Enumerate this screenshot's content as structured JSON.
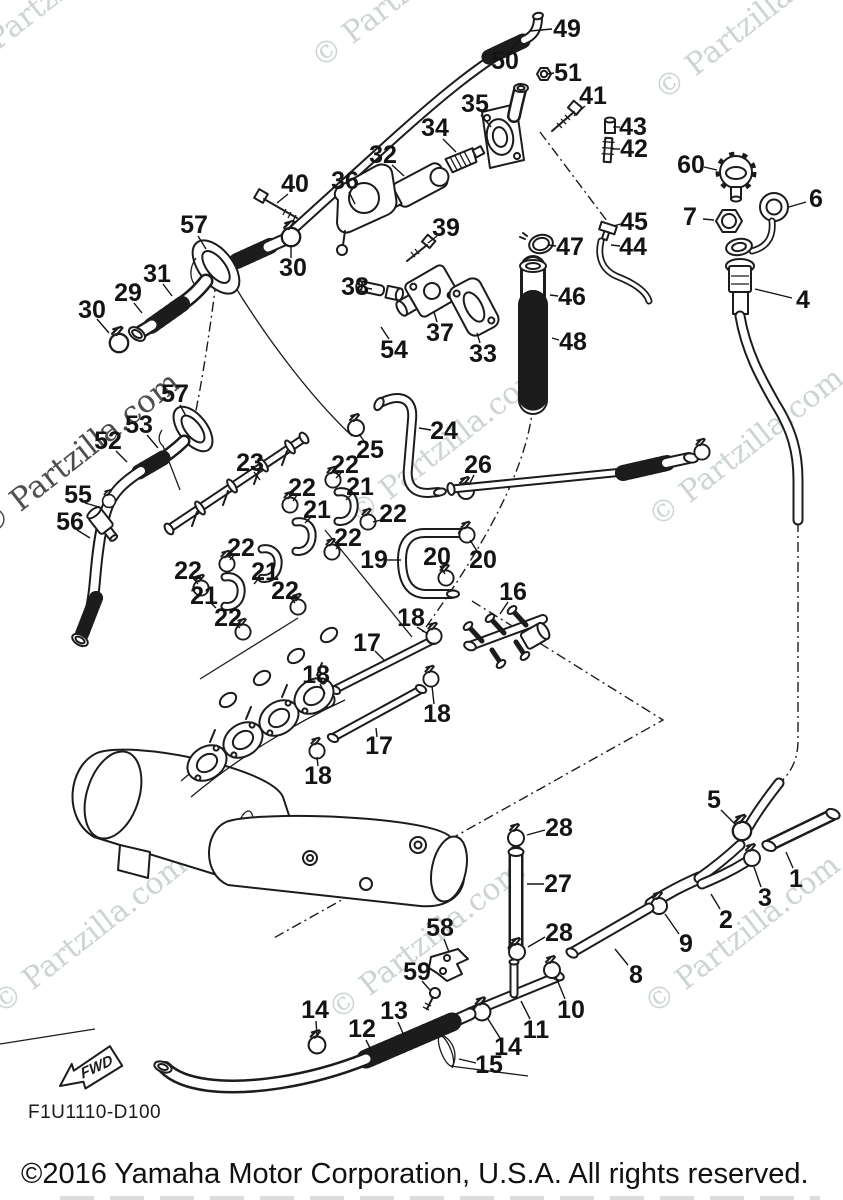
{
  "watermarks": {
    "text": "© Partzilla.com",
    "light_color": "#ccd5d1",
    "dark_color": "#4e4e4e",
    "items": [
      {
        "x": 60,
        "y": 2,
        "r": -38,
        "dark": false
      },
      {
        "x": 415,
        "y": -4,
        "r": -38,
        "dark": false
      },
      {
        "x": 758,
        "y": 28,
        "r": -38,
        "dark": false
      },
      {
        "x": 85,
        "y": 462,
        "r": -38,
        "dark": true
      },
      {
        "x": 452,
        "y": 452,
        "r": -38,
        "dark": false
      },
      {
        "x": 752,
        "y": 455,
        "r": -38,
        "dark": false
      },
      {
        "x": 95,
        "y": 942,
        "r": -38,
        "dark": false
      },
      {
        "x": 432,
        "y": 948,
        "r": -38,
        "dark": false
      },
      {
        "x": 748,
        "y": 942,
        "r": -38,
        "dark": false
      }
    ]
  },
  "diagram": {
    "code": "F1U1110-D100",
    "fwd_label": "FWD",
    "labels": [
      {
        "n": "49",
        "x": 567,
        "y": 29,
        "l": [
          552,
          29,
          530,
          31
        ]
      },
      {
        "n": "50",
        "x": 505,
        "y": 61,
        "l": [
          511,
          50,
          520,
          39
        ]
      },
      {
        "n": "51",
        "x": 568,
        "y": 73,
        "l": [
          554,
          73,
          547,
          74
        ]
      },
      {
        "n": "35",
        "x": 475,
        "y": 104,
        "l": [
          481,
          115,
          491,
          127
        ]
      },
      {
        "n": "41",
        "x": 593,
        "y": 96,
        "l": [
          585,
          106,
          574,
          116
        ]
      },
      {
        "n": "34",
        "x": 435,
        "y": 128,
        "l": [
          443,
          139,
          456,
          152
        ]
      },
      {
        "n": "43",
        "x": 633,
        "y": 127,
        "l": [
          620,
          127,
          613,
          127
        ]
      },
      {
        "n": "42",
        "x": 634,
        "y": 149,
        "l": [
          620,
          149,
          612,
          149
        ]
      },
      {
        "n": "60",
        "x": 691,
        "y": 165,
        "l": [
          704,
          167,
          717,
          170
        ]
      },
      {
        "n": "6",
        "x": 816,
        "y": 199,
        "l": [
          806,
          202,
          789,
          207
        ]
      },
      {
        "n": "7",
        "x": 690,
        "y": 217,
        "l": [
          703,
          219,
          714,
          220
        ]
      },
      {
        "n": "40",
        "x": 295,
        "y": 184,
        "l": [
          288,
          194,
          277,
          203
        ]
      },
      {
        "n": "32",
        "x": 383,
        "y": 155,
        "l": [
          392,
          165,
          404,
          176
        ]
      },
      {
        "n": "36",
        "x": 345,
        "y": 181,
        "l": [
          349,
          192,
          355,
          204
        ]
      },
      {
        "n": "57",
        "x": 194,
        "y": 225,
        "l": [
          198,
          236,
          206,
          249
        ]
      },
      {
        "n": "39",
        "x": 446,
        "y": 228,
        "l": [
          437,
          236,
          428,
          243
        ]
      },
      {
        "n": "30",
        "x": 293,
        "y": 268,
        "l": [
          291,
          258,
          291,
          247
        ]
      },
      {
        "n": "31",
        "x": 157,
        "y": 274,
        "l": [
          163,
          284,
          172,
          296
        ]
      },
      {
        "n": "29",
        "x": 128,
        "y": 293,
        "l": [
          134,
          303,
          142,
          313
        ]
      },
      {
        "n": "38",
        "x": 355,
        "y": 287,
        "l": [
          366,
          288,
          372,
          289
        ]
      },
      {
        "n": "30",
        "x": 92,
        "y": 310,
        "l": [
          97,
          319,
          109,
          333
        ]
      },
      {
        "n": "47",
        "x": 570,
        "y": 247,
        "l": [
          556,
          246,
          548,
          245
        ]
      },
      {
        "n": "45",
        "x": 634,
        "y": 222,
        "l": [
          621,
          224,
          613,
          226
        ]
      },
      {
        "n": "44",
        "x": 633,
        "y": 247,
        "l": [
          620,
          246,
          611,
          245
        ]
      },
      {
        "n": "46",
        "x": 572,
        "y": 297,
        "l": [
          558,
          296,
          550,
          295
        ]
      },
      {
        "n": "4",
        "x": 803,
        "y": 300,
        "l": [
          792,
          298,
          755,
          289
        ]
      },
      {
        "n": "37",
        "x": 440,
        "y": 333,
        "l": [
          437,
          322,
          434,
          312
        ]
      },
      {
        "n": "48",
        "x": 573,
        "y": 342,
        "l": [
          559,
          340,
          552,
          338
        ]
      },
      {
        "n": "33",
        "x": 483,
        "y": 354,
        "l": [
          480,
          343,
          477,
          333
        ]
      },
      {
        "n": "54",
        "x": 394,
        "y": 350,
        "l": [
          389,
          339,
          381,
          327
        ]
      },
      {
        "n": "57",
        "x": 175,
        "y": 394,
        "l": [
          180,
          405,
          186,
          416
        ]
      },
      {
        "n": "53",
        "x": 139,
        "y": 425,
        "l": [
          147,
          435,
          158,
          448
        ]
      },
      {
        "n": "52",
        "x": 108,
        "y": 441,
        "l": [
          116,
          451,
          127,
          462
        ]
      },
      {
        "n": "24",
        "x": 444,
        "y": 431,
        "l": [
          431,
          430,
          419,
          428
        ]
      },
      {
        "n": "25",
        "x": 370,
        "y": 450,
        "l": [
          364,
          441,
          359,
          434
        ]
      },
      {
        "n": "23",
        "x": 250,
        "y": 463,
        "l": [
          254,
          472,
          260,
          480
        ]
      },
      {
        "n": "22",
        "x": 345,
        "y": 465,
        "l": [
          341,
          473,
          336,
          478
        ]
      },
      {
        "n": "26",
        "x": 478,
        "y": 465,
        "l": [
          474,
          475,
          469,
          485
        ]
      },
      {
        "n": "22",
        "x": 302,
        "y": 488,
        "l": [
          297,
          495,
          293,
          501
        ]
      },
      {
        "n": "21",
        "x": 360,
        "y": 487,
        "l": [
          352,
          494,
          346,
          500
        ]
      },
      {
        "n": "55",
        "x": 78,
        "y": 495,
        "l": [
          85,
          503,
          99,
          507
        ]
      },
      {
        "n": "21",
        "x": 317,
        "y": 510,
        "l": [
          311,
          517,
          305,
          523
        ]
      },
      {
        "n": "22",
        "x": 393,
        "y": 514,
        "l": [
          385,
          519,
          373,
          522
        ]
      },
      {
        "n": "56",
        "x": 70,
        "y": 522,
        "l": [
          77,
          530,
          90,
          538
        ]
      },
      {
        "n": "22",
        "x": 348,
        "y": 538,
        "l": [
          341,
          544,
          336,
          549
        ]
      },
      {
        "n": "22",
        "x": 241,
        "y": 548,
        "l": [
          235,
          554,
          230,
          560
        ]
      },
      {
        "n": "20",
        "x": 437,
        "y": 557,
        "l": [
          440,
          566,
          445,
          574
        ]
      },
      {
        "n": "19",
        "x": 374,
        "y": 560,
        "l": [
          387,
          560,
          401,
          560
        ]
      },
      {
        "n": "20",
        "x": 483,
        "y": 560,
        "l": [
          477,
          551,
          470,
          540
        ]
      },
      {
        "n": "22",
        "x": 188,
        "y": 571,
        "l": [
          193,
          578,
          198,
          584
        ]
      },
      {
        "n": "21",
        "x": 265,
        "y": 572,
        "l": [
          259,
          578,
          254,
          584
        ]
      },
      {
        "n": "22",
        "x": 285,
        "y": 591,
        "l": [
          290,
          597,
          295,
          603
        ]
      },
      {
        "n": "16",
        "x": 513,
        "y": 592,
        "l": [
          508,
          602,
          500,
          614
        ]
      },
      {
        "n": "21",
        "x": 204,
        "y": 596,
        "l": [
          210,
          602,
          216,
          608
        ]
      },
      {
        "n": "22",
        "x": 228,
        "y": 618,
        "l": [
          234,
          623,
          240,
          628
        ]
      },
      {
        "n": "18",
        "x": 411,
        "y": 618,
        "l": [
          417,
          627,
          428,
          634
        ]
      },
      {
        "n": "17",
        "x": 367,
        "y": 643,
        "l": [
          375,
          651,
          384,
          660
        ]
      },
      {
        "n": "18",
        "x": 316,
        "y": 675,
        "l": [
          320,
          684,
          325,
          694
        ]
      },
      {
        "n": "18",
        "x": 437,
        "y": 714,
        "l": [
          434,
          704,
          432,
          686
        ]
      },
      {
        "n": "17",
        "x": 379,
        "y": 746,
        "l": [
          377,
          737,
          376,
          728
        ]
      },
      {
        "n": "18",
        "x": 318,
        "y": 776,
        "l": [
          318,
          766,
          317,
          757
        ]
      },
      {
        "n": "5",
        "x": 714,
        "y": 800,
        "l": [
          721,
          810,
          736,
          825
        ]
      },
      {
        "n": "28",
        "x": 559,
        "y": 828,
        "l": [
          545,
          830,
          527,
          835
        ]
      },
      {
        "n": "1",
        "x": 796,
        "y": 879,
        "l": [
          793,
          868,
          786,
          852
        ]
      },
      {
        "n": "27",
        "x": 558,
        "y": 884,
        "l": [
          544,
          884,
          527,
          884
        ]
      },
      {
        "n": "3",
        "x": 765,
        "y": 898,
        "l": [
          761,
          887,
          754,
          867
        ]
      },
      {
        "n": "2",
        "x": 726,
        "y": 920,
        "l": [
          720,
          909,
          711,
          894
        ]
      },
      {
        "n": "28",
        "x": 559,
        "y": 933,
        "l": [
          545,
          937,
          528,
          947
        ]
      },
      {
        "n": "9",
        "x": 686,
        "y": 944,
        "l": [
          679,
          934,
          665,
          914
        ]
      },
      {
        "n": "8",
        "x": 636,
        "y": 975,
        "l": [
          628,
          965,
          615,
          949
        ]
      },
      {
        "n": "58",
        "x": 440,
        "y": 928,
        "l": [
          444,
          939,
          449,
          952
        ]
      },
      {
        "n": "59",
        "x": 417,
        "y": 972,
        "l": [
          422,
          981,
          430,
          990
        ]
      },
      {
        "n": "10",
        "x": 571,
        "y": 1010,
        "l": [
          565,
          999,
          556,
          977
        ]
      },
      {
        "n": "14",
        "x": 315,
        "y": 1010,
        "l": [
          316,
          1021,
          317,
          1036
        ]
      },
      {
        "n": "13",
        "x": 394,
        "y": 1011,
        "l": [
          398,
          1022,
          405,
          1038
        ]
      },
      {
        "n": "11",
        "x": 536,
        "y": 1030,
        "l": [
          530,
          1019,
          521,
          1001
        ]
      },
      {
        "n": "12",
        "x": 362,
        "y": 1029,
        "l": [
          366,
          1040,
          372,
          1052
        ]
      },
      {
        "n": "14",
        "x": 508,
        "y": 1047,
        "l": [
          500,
          1038,
          488,
          1019
        ]
      },
      {
        "n": "15",
        "x": 489,
        "y": 1065,
        "l": [
          476,
          1063,
          459,
          1059
        ]
      }
    ]
  },
  "footer": {
    "copyright": "©2016 Yamaha Motor Corporation, U.S.A. All rights reserved."
  }
}
